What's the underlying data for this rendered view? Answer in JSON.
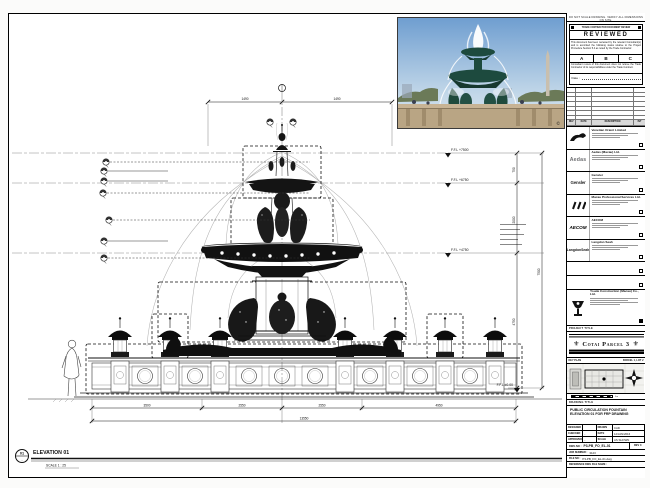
{
  "drawing": {
    "elevation": {
      "tag": "01",
      "tag_sheet": "-",
      "title": "ELEVATION 01",
      "scale": "SCALE 1 : 25"
    },
    "levels": [
      "F.F.L +7500",
      "F.F.L +6750",
      "F.F.L +4750",
      "F.F.L ±0.00"
    ],
    "dims": {
      "top": [
        "1490",
        "1490"
      ],
      "right": [
        "750",
        "2000",
        "4750",
        "7500"
      ],
      "bottom": [
        "3500",
        "2550",
        "2550",
        "4950"
      ],
      "bottom_total": "13550"
    }
  },
  "photo": {
    "watermark": "©"
  },
  "titleblock": {
    "top_note": "DO NOT SCALE DRAWING. VERIFY ALL DIMENSIONS ON SITE.",
    "stamp": {
      "header": "TRADE CONTRACTOR DOCUMENT REVIEW",
      "title": "REVIEWED",
      "para1": "This document has been reviewed by the relevant Consultant(s) and is accorded the following status relative to the Project Procedure Section 5.4 as noted by the Trade Contractor.",
      "options": [
        "A",
        "B",
        "C"
      ],
      "para2": "Consultant review of this document does not relieve the Trade Contractor of its responsibilities under the Trade Contract.",
      "date_label": "Date :"
    },
    "revision_header": [
      "REV",
      "DATE",
      "DESCRIPTION",
      "INT"
    ],
    "consultants": [
      {
        "name": "Venetian Orient Limited"
      },
      {
        "name": "Aedas (Macau) Ltd.",
        "logo_text": "Aedas"
      },
      {
        "name": "Gensler",
        "logo_text": "Gensler"
      },
      {
        "name": "Macau Professional Services Ltd."
      },
      {
        "name": "AECOM",
        "logo_text": "AECOM"
      },
      {
        "name": "Langdon Seah",
        "logo_text": "LangdonSeah"
      }
    ],
    "contractor": {
      "name": "Youde Construction (Macau) Co., Ltd."
    },
    "project_title_label": "PROJECT TITLE",
    "project_title": "Cotai Parcel 3",
    "ornament": "⚜",
    "key_plan": {
      "label": "KEY PLAN",
      "parcel": "PARCEL 1, LOT 2"
    },
    "scale_bar_end": "5m",
    "drawing_title_label": "DRAWING TITLE",
    "drawing_title": "PUBLIC CIRCULATION FOUNTAIN ELEVATION 01 FOR FRP DRAWING",
    "info": {
      "designed_label": "DESIGNED",
      "designed": "",
      "drawn_label": "DRAWN",
      "drawn": "CAD",
      "checked_label": "CHECKED",
      "checked": "-",
      "date_label": "DATE",
      "date": "12/JAN/2016",
      "approved_label": "APPROVED",
      "approved": "-",
      "scale_label": "SCALE",
      "scale": "AS SHOWN"
    },
    "dwg_no_label": "DWG NO :",
    "dwg_no": "P3-PB_FO_EL-01",
    "rev_label": "REV",
    "rev": "0",
    "job_label": "JOB NUMBER :",
    "job": "3123",
    "file_label": "FILE NO :",
    "file": "P3-PB_FO_EL-01.dwg",
    "ref_label": "REFERENCE DWG FILE NAME :"
  }
}
